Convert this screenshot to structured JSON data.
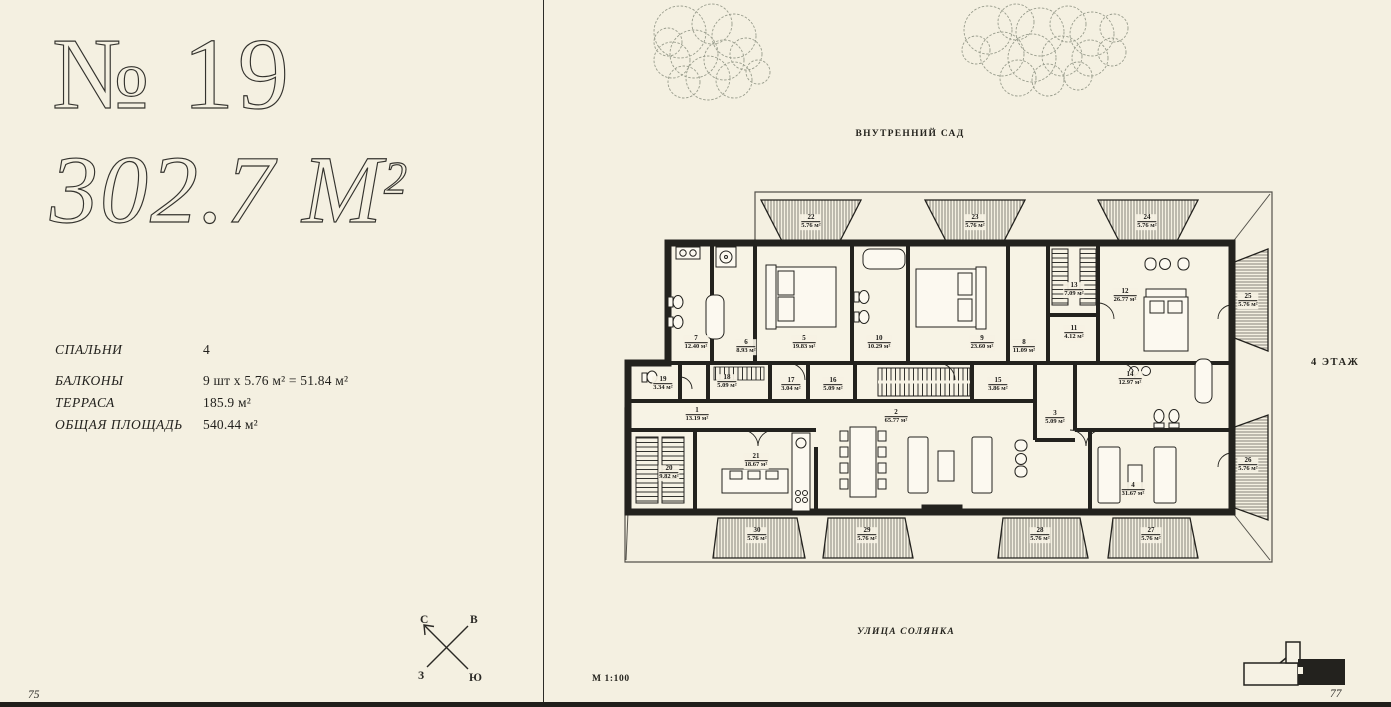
{
  "page": {
    "left_number": "75",
    "right_number": "77"
  },
  "listing": {
    "number_title": "№ 19",
    "area_title": "302.7 М",
    "area_superscript": "2",
    "specs": [
      {
        "label": "СПАЛЬНИ",
        "value": "4"
      },
      {
        "label": "БАЛКОНЫ",
        "value": "9 шт x 5.76 м² = 51.84 м²"
      },
      {
        "label": "ТЕРРАСА",
        "value": "185.9 м²"
      },
      {
        "label": "ОБЩАЯ ПЛОЩАДЬ",
        "value": "540.44 м²"
      }
    ]
  },
  "compass": {
    "north": "С",
    "east": "В",
    "west": "З",
    "south": "Ю"
  },
  "floor_plan": {
    "garden_label": "ВНУТРЕННИЙ САД",
    "street_label": "УЛИЦА СОЛЯНКА",
    "floor_label": "4 ЭТАЖ",
    "scale_label": "М 1:100",
    "rooms": [
      {
        "number": "1",
        "area": "13.19 м²",
        "x": 77,
        "y": 230
      },
      {
        "number": "2",
        "area": "65.77 м²",
        "x": 276,
        "y": 232
      },
      {
        "number": "3",
        "area": "5.09 м²",
        "x": 435,
        "y": 233
      },
      {
        "number": "4",
        "area": "31.67 м²",
        "x": 513,
        "y": 305
      },
      {
        "number": "5",
        "area": "19.83 м²",
        "x": 184,
        "y": 158
      },
      {
        "number": "6",
        "area": "8.93 м²",
        "x": 126,
        "y": 162
      },
      {
        "number": "7",
        "area": "12.40 м²",
        "x": 76,
        "y": 158
      },
      {
        "number": "8",
        "area": "11.09 м²",
        "x": 404,
        "y": 162
      },
      {
        "number": "9",
        "area": "23.60 м²",
        "x": 362,
        "y": 158
      },
      {
        "number": "10",
        "area": "10.29 м²",
        "x": 259,
        "y": 158
      },
      {
        "number": "11",
        "area": "4.12 м²",
        "x": 454,
        "y": 148
      },
      {
        "number": "12",
        "area": "26.77 м²",
        "x": 505,
        "y": 111
      },
      {
        "number": "13",
        "area": "7.09 м²",
        "x": 454,
        "y": 105
      },
      {
        "number": "14",
        "area": "12.97 м²",
        "x": 510,
        "y": 194
      },
      {
        "number": "15",
        "area": "3.86 м²",
        "x": 378,
        "y": 200
      },
      {
        "number": "16",
        "area": "5.09 м²",
        "x": 213,
        "y": 200
      },
      {
        "number": "17",
        "area": "3.04 м²",
        "x": 171,
        "y": 200
      },
      {
        "number": "18",
        "area": "5.09 м²",
        "x": 107,
        "y": 197
      },
      {
        "number": "19",
        "area": "3.34 м²",
        "x": 43,
        "y": 199
      },
      {
        "number": "20",
        "area": "9.82 м²",
        "x": 49,
        "y": 288
      },
      {
        "number": "21",
        "area": "18.67 м²",
        "x": 136,
        "y": 276
      }
    ],
    "balconies": [
      {
        "number": "22",
        "area": "5.76 м²",
        "x": 191,
        "y": 37
      },
      {
        "number": "23",
        "area": "5.76 м²",
        "x": 355,
        "y": 37
      },
      {
        "number": "24",
        "area": "5.76 м²",
        "x": 527,
        "y": 37
      },
      {
        "number": "25",
        "area": "5.76 м²",
        "x": 628,
        "y": 116
      },
      {
        "number": "26",
        "area": "5.76 м²",
        "x": 628,
        "y": 280
      },
      {
        "number": "27",
        "area": "5.76 м²",
        "x": 531,
        "y": 350
      },
      {
        "number": "28",
        "area": "5.76 м²",
        "x": 420,
        "y": 350
      },
      {
        "number": "29",
        "area": "5.76 м²",
        "x": 247,
        "y": 350
      },
      {
        "number": "30",
        "area": "5.76 м²",
        "x": 137,
        "y": 350
      }
    ]
  }
}
